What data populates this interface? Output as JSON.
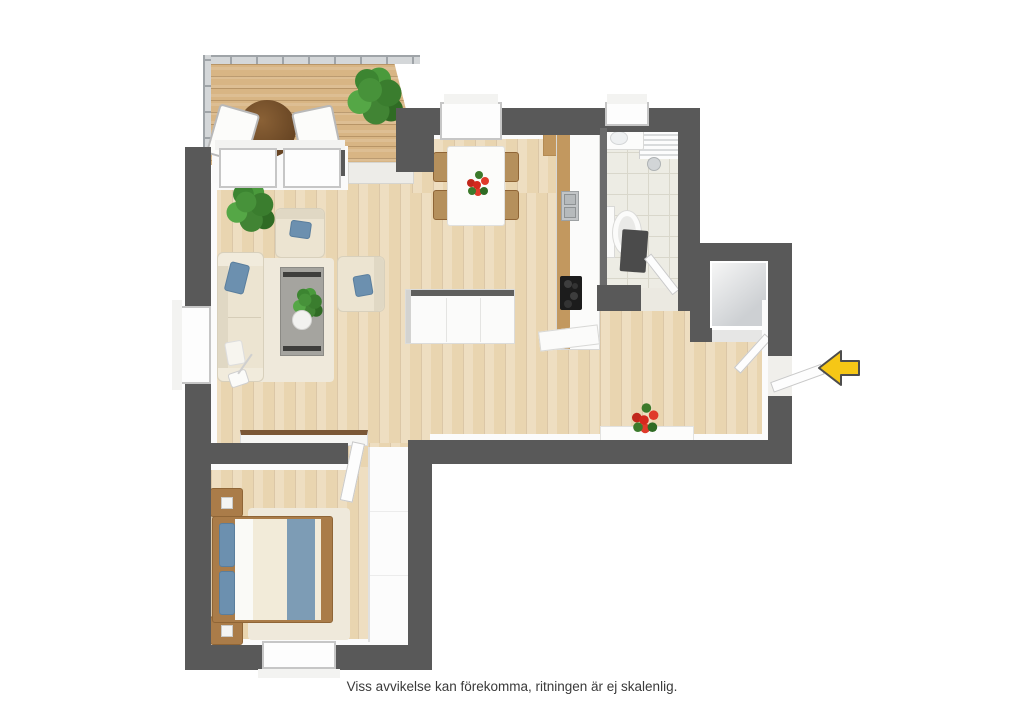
{
  "caption": "Viss avvikelse kan förekomma, ritningen är ej skalenlig.",
  "plan": {
    "type": "3d-top-down-floor-plan",
    "entrance_arrow": {
      "direction": "left",
      "meaning": "entrance"
    },
    "rooms": [
      {
        "name": "balcony",
        "floor": "wood-deck",
        "furniture": [
          "round-table",
          "deck-chair",
          "deck-chair",
          "potted-plant"
        ],
        "features": [
          "glass-railing"
        ]
      },
      {
        "name": "living-room",
        "floor": "light-oak",
        "furniture": [
          "sofa",
          "armchair",
          "armchair",
          "coffee-table-with-vase",
          "area-rug",
          "floor-lamp",
          "potted-plant",
          "sideboard"
        ]
      },
      {
        "name": "kitchen-dining",
        "floor": "light-oak",
        "furniture": [
          "dining-table-with-flowers",
          "dining-chair",
          "dining-chair",
          "dining-chair",
          "dining-chair",
          "kitchen-counter",
          "sink",
          "cooktop",
          "kitchen-island"
        ]
      },
      {
        "name": "bathroom",
        "floor": "tile",
        "furniture": [
          "washbasin",
          "toilet",
          "shower",
          "bath-mat"
        ],
        "features": [
          "window"
        ]
      },
      {
        "name": "storage-room",
        "floor": "gray",
        "furniture": []
      },
      {
        "name": "hallway",
        "floor": "light-oak",
        "furniture": [
          "console-with-red-flowers"
        ],
        "features": [
          "entrance-door"
        ]
      },
      {
        "name": "bedroom",
        "floor": "light-oak",
        "furniture": [
          "double-bed",
          "nightstand",
          "nightstand",
          "wardrobe",
          "area-rug"
        ],
        "features": [
          "window"
        ]
      }
    ]
  },
  "colors": {
    "wall": "#595959",
    "wood": "#e9d5b0",
    "deck": "#d8b584",
    "cab": "#c2985f",
    "cream": "#ece4d1",
    "creamline": "#d8d0bc",
    "blue": "#6c90af",
    "runner": "#7d9cb5",
    "bedwood": "#aa7c49",
    "rug": "#efe9db",
    "tile": "#edece4",
    "tileline": "#d9d7cb",
    "arrow": "#f6c716",
    "arrowline": "#4d4d4d",
    "red": "#d5281e",
    "green": "#47923a"
  }
}
